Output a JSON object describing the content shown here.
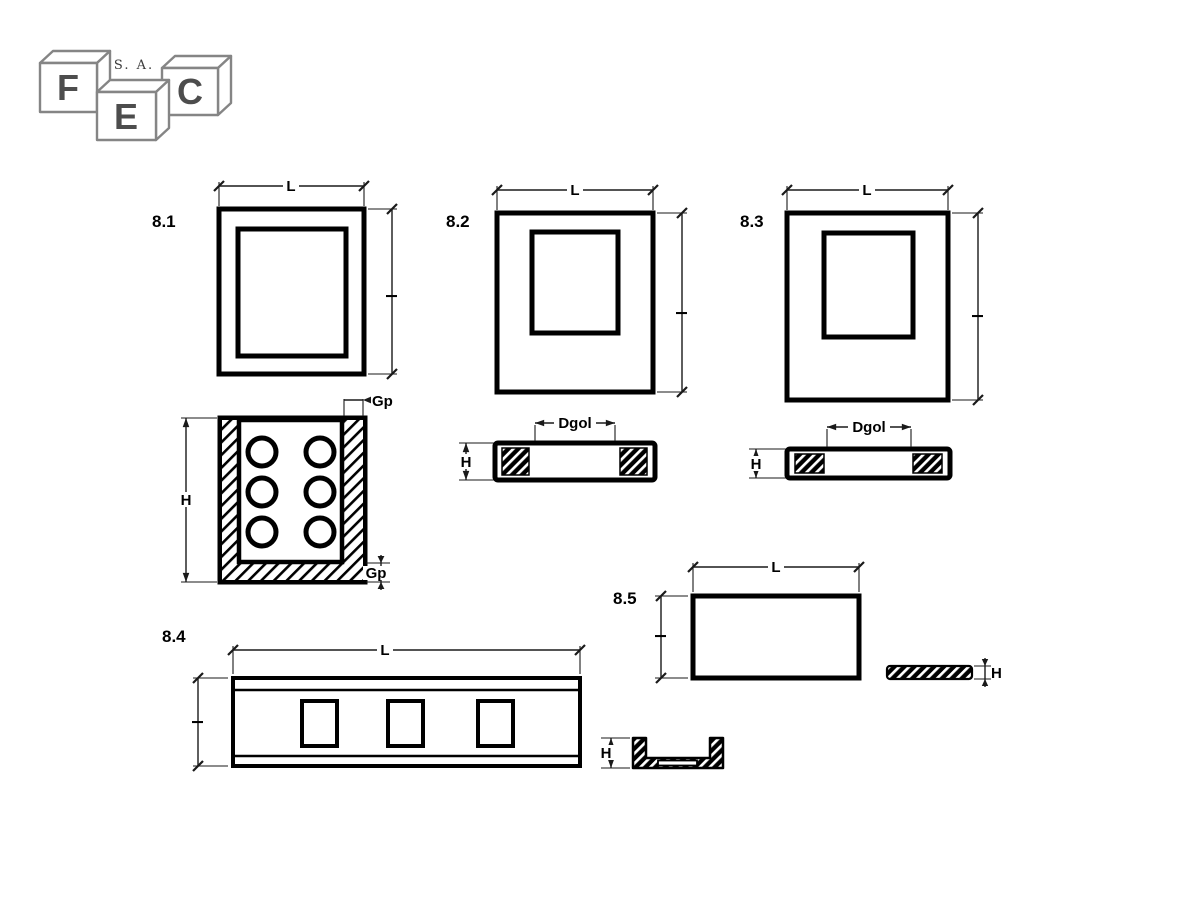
{
  "logo": {
    "letter_f": "F",
    "letter_e": "E",
    "letter_c": "C",
    "company_suffix": "S. A.",
    "outline_color": "#858585",
    "letter_color": "#4d4d4d"
  },
  "drawing": {
    "ink_color": "#000000",
    "background": "#ffffff"
  },
  "figures": {
    "fig81": {
      "label": "8.1",
      "dim_length": "L",
      "dim_height": "l",
      "section": {
        "dim_height": "H",
        "dim_wall": "Gp",
        "dim_floor": "Gp",
        "hole_count": 6
      }
    },
    "fig82": {
      "label": "8.2",
      "dim_length": "L",
      "dim_height": "l",
      "section": {
        "dim_height": "H",
        "dim_gap": "Dgol"
      }
    },
    "fig83": {
      "label": "8.3",
      "dim_length": "L",
      "dim_height": "l",
      "section": {
        "dim_height": "H",
        "dim_gap": "Dgol"
      }
    },
    "fig84": {
      "label": "8.4",
      "dim_length": "L",
      "dim_height": "l",
      "opening_count": 3
    },
    "fig85": {
      "label": "8.5",
      "dim_length": "L",
      "dim_height": "l",
      "plate_section": {
        "dim_height": "H"
      },
      "channel_section": {
        "dim_height": "H"
      }
    }
  }
}
